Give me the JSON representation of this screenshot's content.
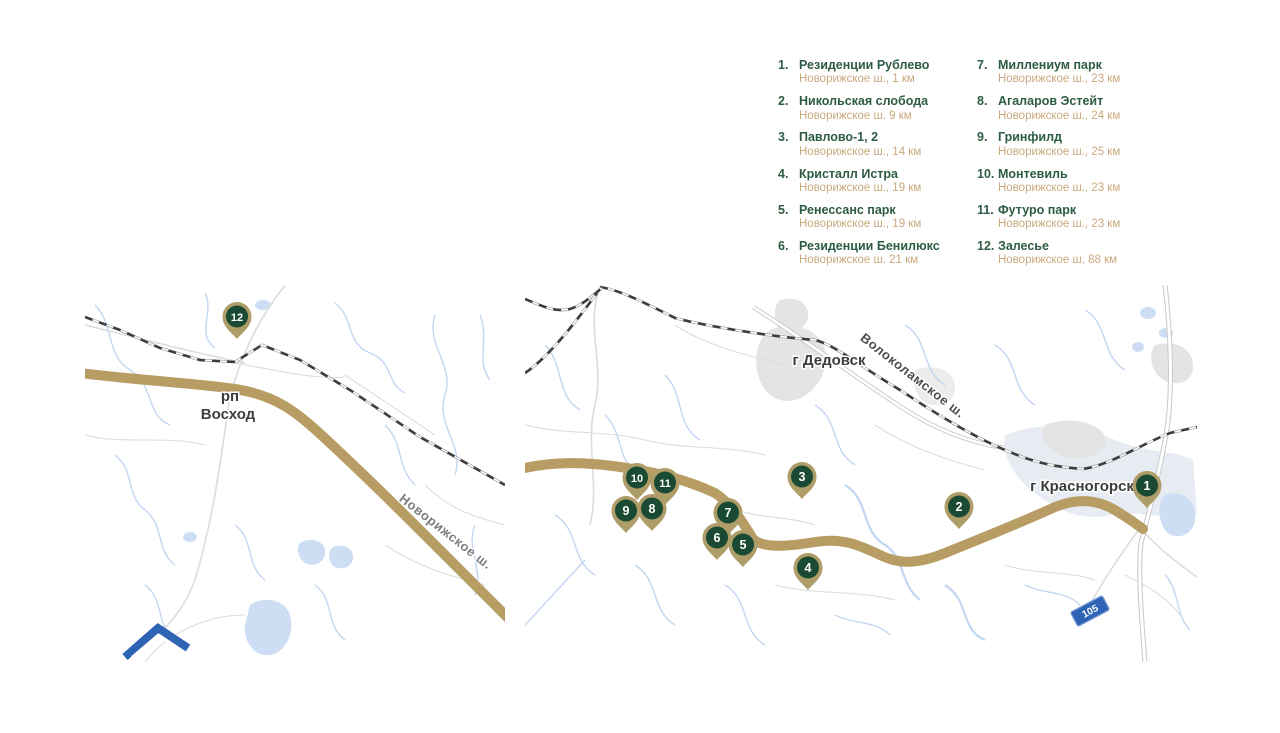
{
  "colors": {
    "legend_green": "#2e5c43",
    "legend_tan": "#c9a87d",
    "pin_green": "#1a4a33",
    "pin_gold": "#ae9d68",
    "road_gold": "#b79d63",
    "shield_blue": "#2e63b5"
  },
  "legend": {
    "columns": [
      {
        "items": [
          {
            "num": "1.",
            "name": "Резиденции Рублево",
            "detail": "Новорижское ш., 1 км"
          },
          {
            "num": "2.",
            "name": "Никольская слобода",
            "detail": "Новорижское ш. 9 км"
          },
          {
            "num": "3.",
            "name": "Павлово-1, 2",
            "detail": "Новорижское ш., 14 км"
          },
          {
            "num": "4.",
            "name": "Кристалл Истра",
            "detail": "Новорижское ш., 19 км"
          },
          {
            "num": "5.",
            "name": "Ренессанс парк",
            "detail": "Новорижское ш., 19 км"
          },
          {
            "num": "6.",
            "name": "Резиденции Бенилюкс",
            "detail": "Новорижское ш. 21 км"
          }
        ]
      },
      {
        "items": [
          {
            "num": "7.",
            "name": "Миллениум парк",
            "detail": "Новорижское ш., 23 км"
          },
          {
            "num": "8.",
            "name": "Агаларов Эстейт",
            "detail": "Новорижское ш., 24 км"
          },
          {
            "num": "9.",
            "name": "Гринфилд",
            "detail": "Новорижское ш., 25 км"
          },
          {
            "num": "10.",
            "name": "Монтевиль",
            "detail": "Новорижское ш., 23 км"
          },
          {
            "num": "11.",
            "name": "Футуро парк",
            "detail": "Новорижское ш., 23 км"
          },
          {
            "num": "12.",
            "name": "Залесье",
            "detail": "Новорижское ш, 88 км"
          }
        ]
      }
    ]
  },
  "maps": {
    "left": {
      "labels": {
        "settlement_prefix": "рп",
        "settlement": "Восход",
        "road": "Новорижское ш."
      },
      "markers": [
        {
          "num": "12",
          "x": 152,
          "y": 33
        }
      ]
    },
    "right": {
      "labels": {
        "city_dedovsk": "г Дедовск",
        "city_krasnogorsk": "г Красногорск",
        "road": "Волоколамское ш."
      },
      "route_shield": "105",
      "markers": [
        {
          "num": "1",
          "x": 622,
          "y": 202
        },
        {
          "num": "2",
          "x": 434,
          "y": 223
        },
        {
          "num": "3",
          "x": 277,
          "y": 193
        },
        {
          "num": "4",
          "x": 283,
          "y": 284
        },
        {
          "num": "5",
          "x": 218,
          "y": 261
        },
        {
          "num": "6",
          "x": 192,
          "y": 254
        },
        {
          "num": "7",
          "x": 203,
          "y": 229
        },
        {
          "num": "8",
          "x": 127,
          "y": 225
        },
        {
          "num": "9",
          "x": 101,
          "y": 227
        },
        {
          "num": "10",
          "x": 112,
          "y": 194
        },
        {
          "num": "11",
          "x": 140,
          "y": 199
        }
      ]
    }
  }
}
